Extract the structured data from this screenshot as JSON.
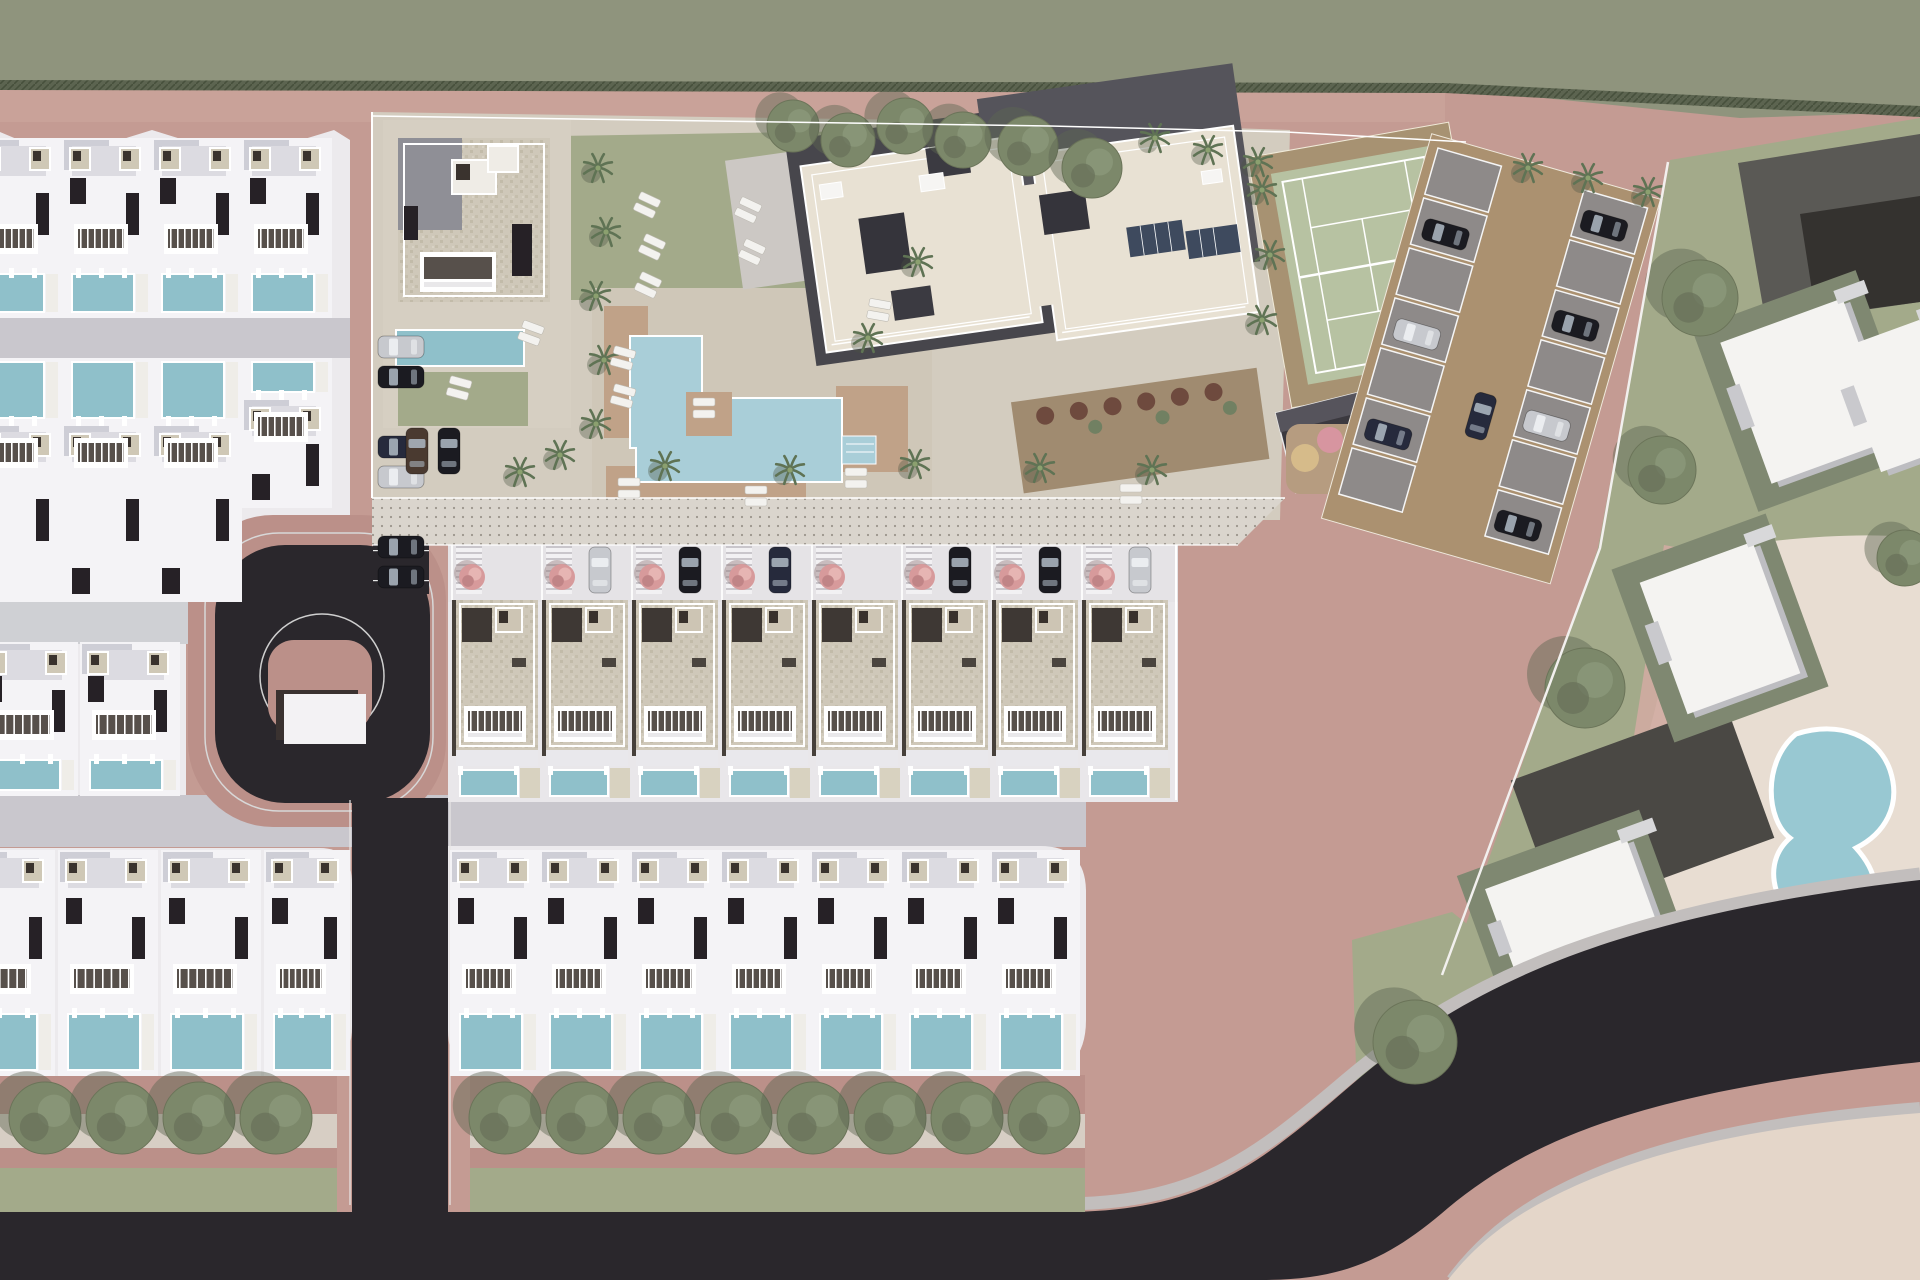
{
  "meta": {
    "description": "Aerial 3D architectural site-plan rendering of a residential development: rows of white villas with private pools, a central amenity zone with communal pool, lawn, apartment block, tennis court and parking, bordered by dusty-pink pedestrian roads and dark asphalt streets with tree rows; a neighbouring parcel with white houses, lawns and a kidney-shaped pond lies to the right.",
    "image_type": "architectural masterplan render",
    "visible_text": []
  },
  "palette": {
    "ground_pink": "#c49b93",
    "ground_pink_dark": "#bb9089",
    "ground_pink_light": "#d0aba1",
    "olive_band": "#8f947d",
    "hedge_dark": "#5c6450",
    "asphalt": "#2a272c",
    "road_gray": "#c9c7cd",
    "sidewalk_gray": "#c2bebd",
    "concrete": "#eceaed",
    "villa_white": "#f4f3f6",
    "villa_shadow": "#c7c7d0",
    "pool_teal": "#8fc0ca",
    "pool_light": "#a9ced8",
    "lawn": "#a3aa8a",
    "lawn_dark": "#7f8871",
    "deck_brown": "#c0a288",
    "paving_beige": "#d3ccbf",
    "promenade_base": "#dad5cd",
    "townhouse_roof": "#cfc8b9",
    "dark_wood": "#46403a",
    "dark_accent": "#262126",
    "tennis_court": "#b7c2a2",
    "tennis_surround": "#a79272",
    "stall_gray": "#8e8a89",
    "aisle_brown": "#ab9170",
    "cream_roof": "#e8e1d3",
    "building_gray": "#47464c",
    "solar": "#3e4a5e",
    "cream_plaza": "#e8ddd2",
    "plot_dark": "#4a4844",
    "plot_gray": "#5a5955",
    "pond": "#98c8d2",
    "tree_green": "#7c886a",
    "tree_dark": "#5d6551",
    "palm_green": "#5f7354",
    "pink_tree": "#d79a9b",
    "car_black": "#1b1b21",
    "car_silver": "#c7c9ce",
    "car_darkblue": "#262a3c",
    "car_brown": "#4a3a30",
    "play_pink": "#d795a0",
    "play_yellow": "#d6bb8a",
    "play_blue": "#7fb0c4"
  },
  "scene": {
    "left_block": {
      "rows": [
        {
          "y": 138,
          "dir": "south",
          "units": [
            {
              "x": -28,
              "w": 90,
              "h": 180
            },
            {
              "x": 62,
              "w": 90,
              "h": 180
            },
            {
              "x": 152,
              "w": 90,
              "h": 180
            },
            {
              "x": 242,
              "w": 90,
              "h": 180
            }
          ]
        },
        {
          "y": 358,
          "dir": "north",
          "units": [
            {
              "x": -28,
              "w": 90,
              "h": 244
            },
            {
              "x": 62,
              "w": 90,
              "h": 244
            },
            {
              "x": 152,
              "w": 90,
              "h": 244
            },
            {
              "x": 242,
              "w": 90,
              "h": 150
            }
          ]
        },
        {
          "y": 642,
          "dir": "south",
          "units": [
            {
              "x": -22,
              "w": 100,
              "h": 154
            },
            {
              "x": 80,
              "w": 100,
              "h": 154
            }
          ]
        },
        {
          "y": 850,
          "dir": "south",
          "units": [
            {
              "x": -45,
              "w": 100,
              "h": 226
            },
            {
              "x": 58,
              "w": 100,
              "h": 226
            },
            {
              "x": 161,
              "w": 100,
              "h": 226
            },
            {
              "x": 264,
              "w": 86,
              "h": 226
            }
          ]
        }
      ]
    },
    "bottom_row": {
      "y": 850,
      "h": 226,
      "w": 90,
      "xs": [
        450,
        540,
        630,
        720,
        810,
        900,
        990
      ]
    },
    "townhouses": {
      "y": 600,
      "w": 90,
      "xs": [
        452,
        542,
        632,
        722,
        812,
        902,
        992,
        1082
      ]
    },
    "pink_trees": {
      "y": 577,
      "r": 13,
      "xs": [
        472,
        562,
        652,
        742,
        832,
        922,
        1012,
        1102
      ]
    },
    "driveway_cars": [
      {
        "u": 1,
        "color": "car_silver"
      },
      {
        "u": 2,
        "color": "car_black"
      },
      {
        "u": 3,
        "color": "car_darkblue"
      },
      {
        "u": 5,
        "color": "car_black"
      },
      {
        "u": 6,
        "color": "car_black"
      },
      {
        "u": 7,
        "color": "car_silver"
      }
    ],
    "parking_strip": {
      "x": 378,
      "cars": [
        {
          "y": 336,
          "color": "car_silver"
        },
        {
          "y": 366,
          "color": "car_black"
        },
        {
          "y": 436,
          "color": "car_darkblue"
        },
        {
          "y": 466,
          "color": "car_silver"
        },
        {
          "y": 536,
          "color": "car_black"
        },
        {
          "y": 566,
          "color": "car_black"
        }
      ]
    },
    "entry_cars": [
      {
        "x": 394,
        "y": 440,
        "rot": 90,
        "color": "car_brown"
      },
      {
        "x": 426,
        "y": 440,
        "rot": 90,
        "color": "car_black"
      }
    ],
    "parking_lot": {
      "tx": 1438,
      "ty": 148,
      "rot": 16,
      "rows": 7,
      "cars": [
        {
          "x": 8,
          "y": 70,
          "color": "car_black"
        },
        {
          "x": 8,
          "y": 174,
          "color": "car_silver"
        },
        {
          "x": 8,
          "y": 278,
          "color": "car_darkblue"
        },
        {
          "x": 158,
          "y": 18,
          "color": "car_black"
        },
        {
          "x": 158,
          "y": 122,
          "color": "car_black"
        },
        {
          "x": 158,
          "y": 226,
          "color": "car_silver"
        },
        {
          "x": 158,
          "y": 330,
          "color": "car_black"
        },
        {
          "x": 92,
          "y": 235,
          "rot": 90,
          "color": "car_darkblue"
        }
      ]
    },
    "street_trees": {
      "y": 1118,
      "r": 36,
      "xs": [
        45,
        122,
        199,
        276,
        505,
        582,
        659,
        736,
        813,
        890,
        967,
        1044
      ]
    },
    "top_trees": [
      [
        793,
        126,
        26
      ],
      [
        848,
        140,
        27
      ],
      [
        905,
        126,
        28
      ],
      [
        963,
        140,
        28
      ],
      [
        1028,
        146,
        30
      ],
      [
        1092,
        168,
        30
      ]
    ],
    "right_trees": [
      [
        1700,
        298,
        38
      ],
      [
        1662,
        470,
        34
      ],
      [
        1585,
        688,
        40
      ],
      [
        1415,
        1042,
        42
      ],
      [
        1905,
        558,
        28
      ]
    ],
    "palms": [
      [
        598,
        168
      ],
      [
        606,
        232
      ],
      [
        596,
        296
      ],
      [
        604,
        360
      ],
      [
        596,
        424
      ],
      [
        560,
        455
      ],
      [
        520,
        472
      ],
      [
        665,
        466
      ],
      [
        790,
        470
      ],
      [
        915,
        464
      ],
      [
        1040,
        468
      ],
      [
        1152,
        470
      ],
      [
        868,
        338
      ],
      [
        918,
        262
      ],
      [
        1262,
        190
      ],
      [
        1270,
        255
      ],
      [
        1262,
        320
      ],
      [
        1155,
        138
      ],
      [
        1208,
        150
      ],
      [
        1258,
        162
      ],
      [
        1528,
        168
      ],
      [
        1588,
        178
      ],
      [
        1648,
        192
      ]
    ],
    "loungers": [
      [
        612,
        348,
        15
      ],
      [
        612,
        386,
        15
      ],
      [
        693,
        398,
        0
      ],
      [
        636,
        195,
        25
      ],
      [
        641,
        237,
        25
      ],
      [
        637,
        275,
        25
      ],
      [
        737,
        200,
        25
      ],
      [
        741,
        242,
        25
      ],
      [
        845,
        468,
        0
      ],
      [
        618,
        478,
        0
      ],
      [
        745,
        486,
        0
      ],
      [
        1120,
        484,
        0
      ],
      [
        448,
        378,
        15
      ],
      [
        520,
        323,
        20
      ],
      [
        868,
        300,
        10
      ]
    ],
    "right_buildings": [
      {
        "x": 1742,
        "y": 316,
        "w": 130,
        "h": 150,
        "rot": -20,
        "pad": true
      },
      {
        "x": 1660,
        "y": 558,
        "w": 120,
        "h": 140,
        "rot": -20,
        "pad": true
      },
      {
        "x": 1500,
        "y": 860,
        "w": 150,
        "h": 114,
        "rot": -20,
        "pad": true
      },
      {
        "x": 1856,
        "y": 330,
        "w": 94,
        "h": 130,
        "rot": -20,
        "pad": false
      }
    ],
    "playground": [
      {
        "x": 1305,
        "y": 458,
        "r": 14,
        "color": "play_yellow"
      },
      {
        "x": 1330,
        "y": 440,
        "r": 13,
        "color": "play_pink"
      },
      {
        "x": 1354,
        "y": 472,
        "r": 12,
        "color": "play_blue"
      }
    ],
    "terrace_shrubs": {
      "y": 404,
      "xs": [
        1048,
        1082,
        1116,
        1150,
        1184,
        1218
      ]
    }
  }
}
